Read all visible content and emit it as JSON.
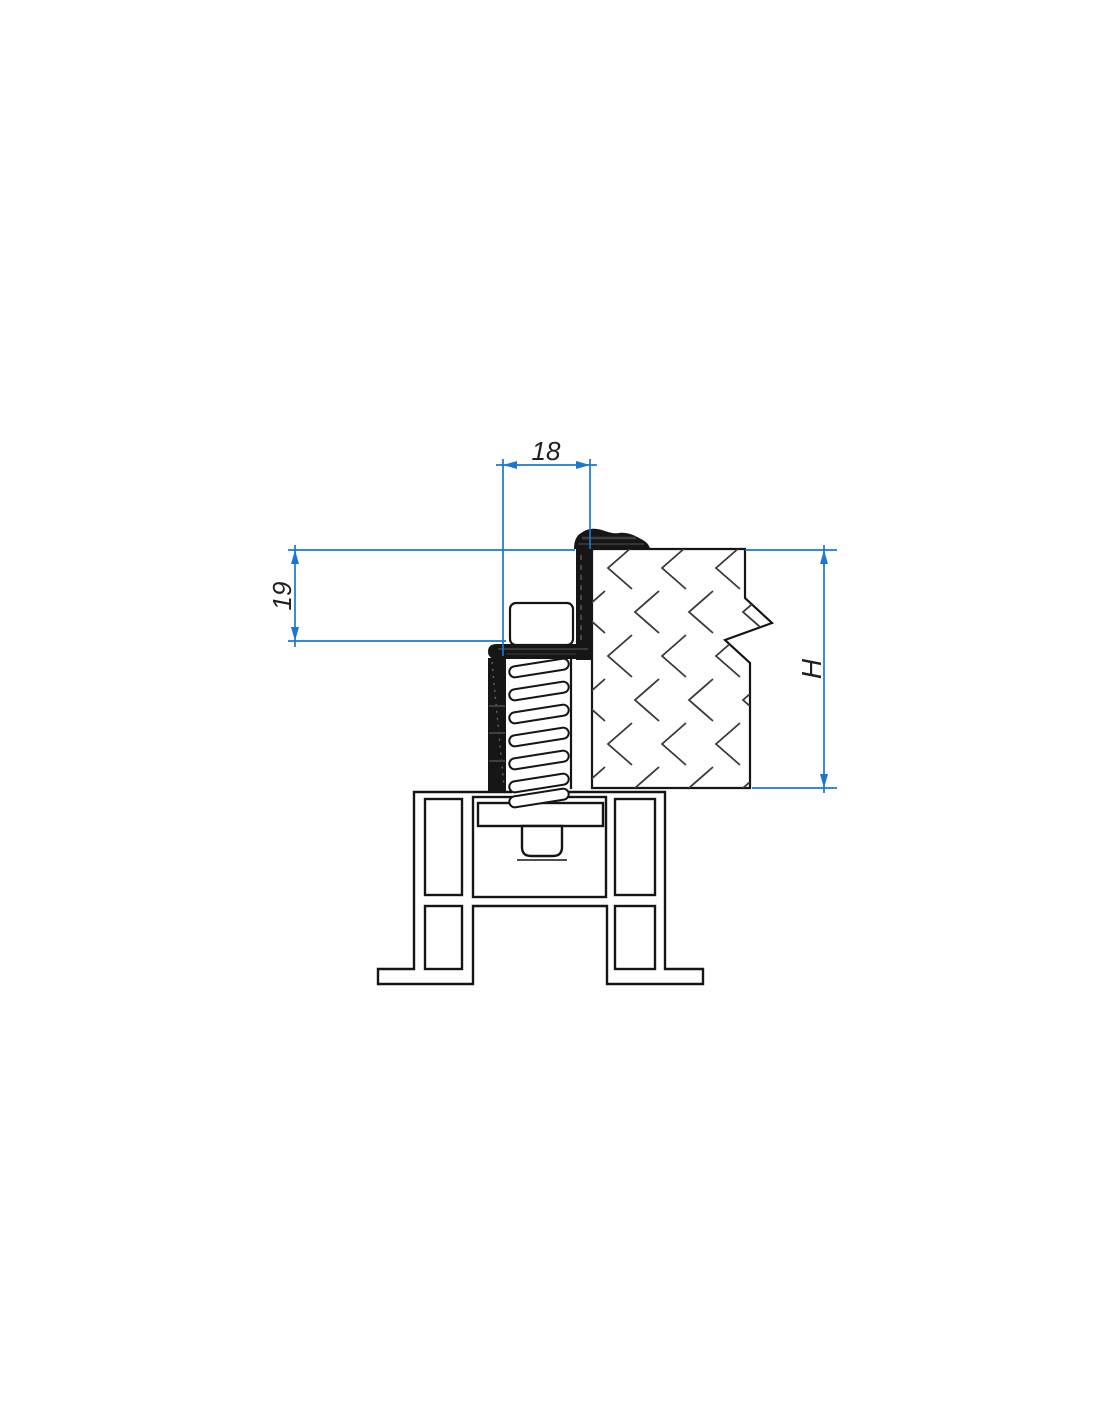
{
  "drawing": {
    "dimensions": {
      "width": {
        "label": "18"
      },
      "offset": {
        "label": "19"
      },
      "height": {
        "label": "H"
      }
    },
    "colors": {
      "dimension_line": "#1b76d2",
      "dimension_text": "#1f1f1f",
      "outline": "#151515",
      "black_fill": "#161616",
      "hatch": "#3a3a3a",
      "background": "#ffffff"
    }
  }
}
